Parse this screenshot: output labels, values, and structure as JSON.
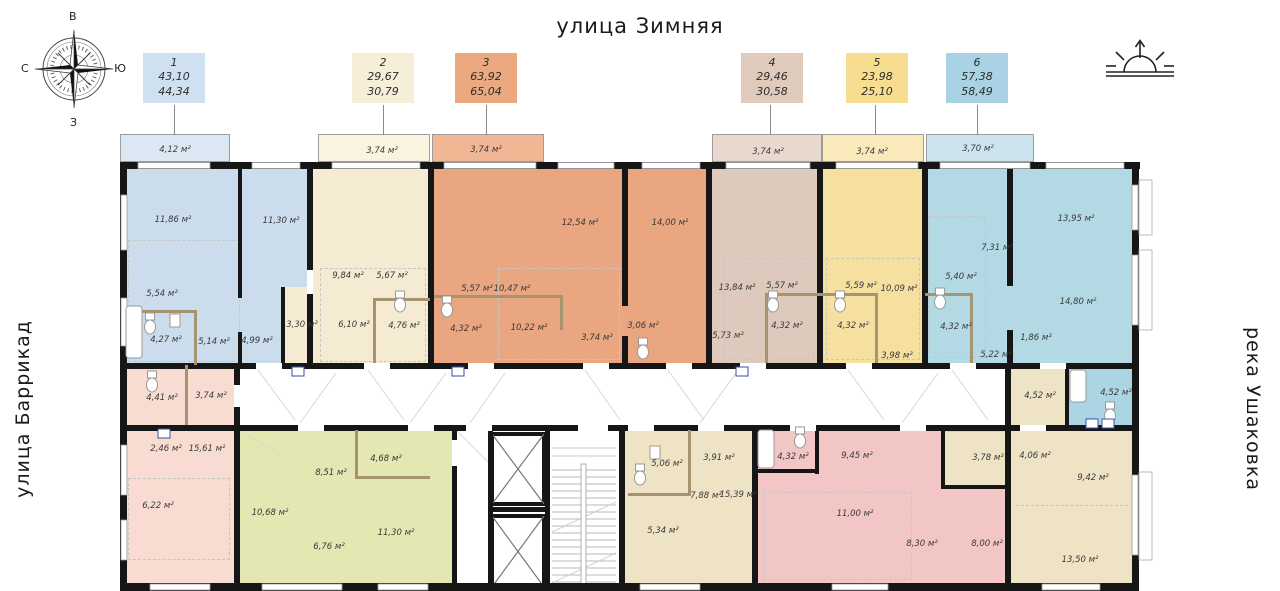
{
  "streets": {
    "top": "улица Зимняя",
    "left": "улица Баррикад",
    "right": "река Ушаковка"
  },
  "compass": {
    "top": "В",
    "right": "Ю",
    "bottom": "З",
    "left": "С"
  },
  "legend": [
    {
      "number": "1",
      "area1": "43,10",
      "area2": "44,34",
      "color": "#cfe0f0"
    },
    {
      "number": "2",
      "area1": "29,67",
      "area2": "30,79",
      "color": "#f7eed8"
    },
    {
      "number": "3",
      "area1": "63,92",
      "area2": "65,04",
      "color": "#eca87f"
    },
    {
      "number": "4",
      "area1": "29,46",
      "area2": "30,58",
      "color": "#dfcabc"
    },
    {
      "number": "5",
      "area1": "23,98",
      "area2": "25,10",
      "color": "#f6dd90"
    },
    {
      "number": "6",
      "area1": "57,38",
      "area2": "58,49",
      "color": "#a9d2e4"
    }
  ],
  "palette": {
    "apt1": "#cbdcec",
    "apt2": "#f5ebd2",
    "apt3": "#eaa581",
    "apt4": "#ddcabd",
    "apt5": "#f5e0a0",
    "apt6": "#b3d9e5",
    "pink": "#f8dcd2",
    "green": "#e4e7b2",
    "tan": "#efe3c5",
    "rose": "#f2c6c5",
    "blue_bath": "#abd5e2",
    "walls": "#161616"
  },
  "rooms": [
    {
      "label": "4,12 м²",
      "x": 175,
      "y": 150
    },
    {
      "label": "3,74 м²",
      "x": 382,
      "y": 151
    },
    {
      "label": "3,74 м²",
      "x": 486,
      "y": 150
    },
    {
      "label": "3,74 м²",
      "x": 768,
      "y": 152
    },
    {
      "label": "3,74 м²",
      "x": 872,
      "y": 152
    },
    {
      "label": "3,70 м²",
      "x": 978,
      "y": 149
    },
    {
      "label": "11,86 м²",
      "x": 173,
      "y": 220
    },
    {
      "label": "11,30 м²",
      "x": 281,
      "y": 221
    },
    {
      "label": "5,54 м²",
      "x": 162,
      "y": 294
    },
    {
      "label": "4,27 м²",
      "x": 166,
      "y": 340
    },
    {
      "label": "5,14 м²",
      "x": 214,
      "y": 342
    },
    {
      "label": "4,99 м²",
      "x": 257,
      "y": 341
    },
    {
      "label": "9,84 м²",
      "x": 348,
      "y": 276
    },
    {
      "label": "5,67 м²",
      "x": 392,
      "y": 276
    },
    {
      "label": "3,30 м²",
      "x": 302,
      "y": 325
    },
    {
      "label": "6,10 м²",
      "x": 354,
      "y": 325
    },
    {
      "label": "4,76 м²",
      "x": 404,
      "y": 326
    },
    {
      "label": "12,54 м²",
      "x": 580,
      "y": 223
    },
    {
      "label": "14,00 м²",
      "x": 670,
      "y": 223
    },
    {
      "label": "5,57 м²",
      "x": 477,
      "y": 289
    },
    {
      "label": "10,47 м²",
      "x": 512,
      "y": 289
    },
    {
      "label": "4,32 м²",
      "x": 466,
      "y": 329
    },
    {
      "label": "10,22 м²",
      "x": 529,
      "y": 328
    },
    {
      "label": "3,74 м²",
      "x": 597,
      "y": 338
    },
    {
      "label": "3,06 м²",
      "x": 643,
      "y": 326
    },
    {
      "label": "13,84 м²",
      "x": 737,
      "y": 288
    },
    {
      "label": "5,57 м²",
      "x": 782,
      "y": 286
    },
    {
      "label": "5,73 м²",
      "x": 728,
      "y": 336
    },
    {
      "label": "4,32 м²",
      "x": 787,
      "y": 326
    },
    {
      "label": "5,59 м²",
      "x": 861,
      "y": 286
    },
    {
      "label": "10,09 м²",
      "x": 899,
      "y": 289
    },
    {
      "label": "4,32 м²",
      "x": 853,
      "y": 326
    },
    {
      "label": "3,98 м²",
      "x": 897,
      "y": 356
    },
    {
      "label": "13,95 м²",
      "x": 1076,
      "y": 219
    },
    {
      "label": "7,31 м²",
      "x": 997,
      "y": 248
    },
    {
      "label": "5,40 м²",
      "x": 961,
      "y": 277
    },
    {
      "label": "14,80 м²",
      "x": 1078,
      "y": 302
    },
    {
      "label": "4,32 м²",
      "x": 956,
      "y": 327
    },
    {
      "label": "1,86 м²",
      "x": 1036,
      "y": 338
    },
    {
      "label": "5,22 м²",
      "x": 996,
      "y": 355
    },
    {
      "label": "4,41 м²",
      "x": 162,
      "y": 398
    },
    {
      "label": "3,74 м²",
      "x": 211,
      "y": 396
    },
    {
      "label": "4,52 м²",
      "x": 1040,
      "y": 396
    },
    {
      "label": "4,52 м²",
      "x": 1116,
      "y": 393
    },
    {
      "label": "2,46 м²",
      "x": 166,
      "y": 449
    },
    {
      "label": "15,61 м²",
      "x": 207,
      "y": 449
    },
    {
      "label": "6,22 м²",
      "x": 158,
      "y": 506
    },
    {
      "label": "8,51 м²",
      "x": 331,
      "y": 473
    },
    {
      "label": "4,68 м²",
      "x": 386,
      "y": 459
    },
    {
      "label": "10,68 м²",
      "x": 270,
      "y": 513
    },
    {
      "label": "6,76 м²",
      "x": 329,
      "y": 547
    },
    {
      "label": "11,30 м²",
      "x": 396,
      "y": 533
    },
    {
      "label": "5,06 м²",
      "x": 667,
      "y": 464
    },
    {
      "label": "3,91 м²",
      "x": 719,
      "y": 458
    },
    {
      "label": "7,88 м²",
      "x": 706,
      "y": 496
    },
    {
      "label": "15,39 м²",
      "x": 738,
      "y": 495
    },
    {
      "label": "5,34 м²",
      "x": 663,
      "y": 531
    },
    {
      "label": "4,32 м²",
      "x": 793,
      "y": 457
    },
    {
      "label": "9,45 м²",
      "x": 857,
      "y": 456
    },
    {
      "label": "11,00 м²",
      "x": 855,
      "y": 514
    },
    {
      "label": "8,30 м²",
      "x": 922,
      "y": 544
    },
    {
      "label": "8,00 м²",
      "x": 987,
      "y": 544
    },
    {
      "label": "3,78 м²",
      "x": 988,
      "y": 458
    },
    {
      "label": "4,06 м²",
      "x": 1035,
      "y": 456
    },
    {
      "label": "9,42 м²",
      "x": 1093,
      "y": 478
    },
    {
      "label": "13,50 м²",
      "x": 1080,
      "y": 560
    }
  ]
}
